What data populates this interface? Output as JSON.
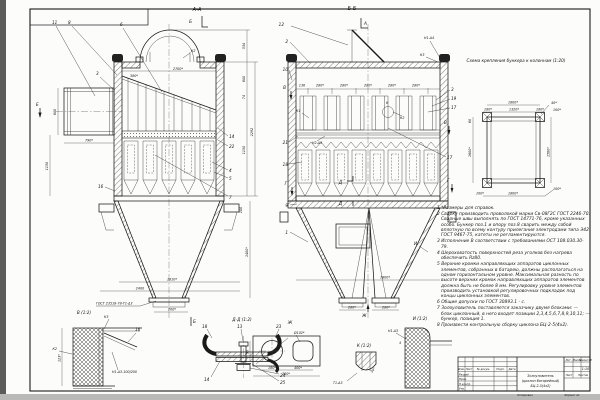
{
  "aa": {
    "title": "А-А",
    "markB": "Б",
    "markB2": "Б",
    "markE": "Е",
    "k2": "К2",
    "it11": "11",
    "it8": "8",
    "it6": "6",
    "it3": "3",
    "it14": "14",
    "it22": "22",
    "it4": "4",
    "it5": "5",
    "it7": "7",
    "it16": "16",
    "d534": "534",
    "d2700": "2700*",
    "d380": "380*",
    "d600": "600",
    "d790": "790*",
    "d1150": "1150",
    "d600r": "600",
    "d74": "74",
    "d1150r": "1150",
    "d2292": "2292",
    "d1810": "1810*",
    "d2400": "2400",
    "d200": "200*",
    "d1400": "1400*",
    "d100": "100",
    "weld": "ГОСТ 23518-78-Т1-Δ3"
  },
  "bb": {
    "title": "Б-Б",
    "markA": "А",
    "markVl": "В",
    "markVr": "В",
    "markGl": "Г",
    "markGr": "Г",
    "markD1": "Д",
    "markD2": "Д",
    "markJ": "Ж",
    "markI": "И",
    "it12": "12",
    "it2": "2",
    "it10": "10",
    "it21": "21",
    "it18": "18",
    "it9": "9",
    "it1": "1",
    "it3": "3",
    "it19": "19",
    "it20": "20",
    "it17": "17",
    "d136": "136",
    "d280_1": "280*",
    "d280_2": "280*",
    "d280_3": "280*",
    "d280_4": "280*",
    "d280_5": "280*",
    "d1800": "1800*",
    "dOut1": "280*",
    "dOut2": "280*",
    "w1": "Н1-Δ4",
    "w2": "К3",
    "w3": "К1",
    "w4": "К2",
    "w5": "Н2-Δ3",
    "wK": "К"
  },
  "sc": {
    "title": "Схема крепления бункера к колоннам (1:20)",
    "dTop": "1800*",
    "dT180l": "180*",
    "dT1320": "1320*",
    "dT180r": "180*",
    "d40": "40*",
    "d100tr": "100*",
    "d60": "60",
    "d1600": "1600*",
    "d1580": "1580*",
    "dB100l": "100*",
    "dB1800": "1800*",
    "dB100r": "100*"
  },
  "dt": {
    "v": {
      "label": "В (1:2)",
      "k3": "К3",
      "it16": "16",
      "k2": "К2",
      "d123": "123*",
      "weld": "Н1-Δ3-100/200"
    },
    "dd": {
      "label": "Д-Д (1:2)",
      "it18": "18",
      "it13": "13",
      "it23": "23",
      "it14": "14",
      "it24": "24",
      "it25": "25"
    },
    "j": {
      "label": "Ж",
      "hole": "Ø102*",
      "d90": "90",
      "d180": "180*",
      "d400": "400*",
      "d760": "760*"
    },
    "k": {
      "label": "К (1:2)",
      "weld": "Т1-Δ3",
      "ang": "30°"
    },
    "i": {
      "label": "И (1:2)",
      "weld": "Н1-Δ3",
      "d4": "4"
    }
  },
  "nt": {
    "n1": "1 *Размеры для справок.",
    "n2": "2 Сварку производить проволокой марки Св-08Г2С ГОСТ 2246-70. Сварные швы выполнять по ГОСТ 14771-76, кроме указанных особо. Бункер поз.1 и опору поз.8 сварить между собой вплотную по всему контуру прилегания электродами типа Э42 ГОСТ 9467-75, катеты не регламентируются.",
    "n3": "3 Исполнение В соответствии с требованиями ОСТ 108.030.30-79.",
    "n4": "4 Шероховатость поверхностей реза уголков без нагрева обеспечить Rz80.",
    "n5": "5 Верхние кромки направляющих аппаратов циклонных элементов, собранных в батарею, должны располагаться на одном горизонтальном уровне. Максимальная разность по высоте верхних кромок направляющих аппаратов элементов должна быть не более 8 мм. Регулировку уровня элементов производить установкой регулировочных подкладок под концы циклонных элементов.",
    "n6": "6 Общие допуски по ГОСТ 30893.1 - с.",
    "n7": "7 Золоуловитель поставляется заказчику двумя блоками: — блок циклонный, в него входят позиции 2,3,4,5,6,7,8,9,10,11; — бункер, позиция 1.",
    "n8": "8 Произвести контрольную сборку циклона БЦ-2-5(4х2)."
  },
  "tb": {
    "name1": "Золоуловитель",
    "name2": "(циклон батарейный)",
    "name3": "БЦ-2-5(4х2)",
    "scale_value": "1:10",
    "col_izm": "Изм.",
    "col_list": "Лист",
    "col_ndok": "№ докум.",
    "col_podp": "Подп.",
    "col_data": "Дата",
    "row_razrab": "Разраб.",
    "row_prov": "Пров.",
    "row_nkontr": "Н.контр.",
    "row_utv": "Утв.",
    "lit": "Лит.",
    "massa": "Масса",
    "masshtab": "Масштаб",
    "list": "Лист",
    "listov": "Листов",
    "kopiroval": "Копировал",
    "format": "Формат А1"
  }
}
